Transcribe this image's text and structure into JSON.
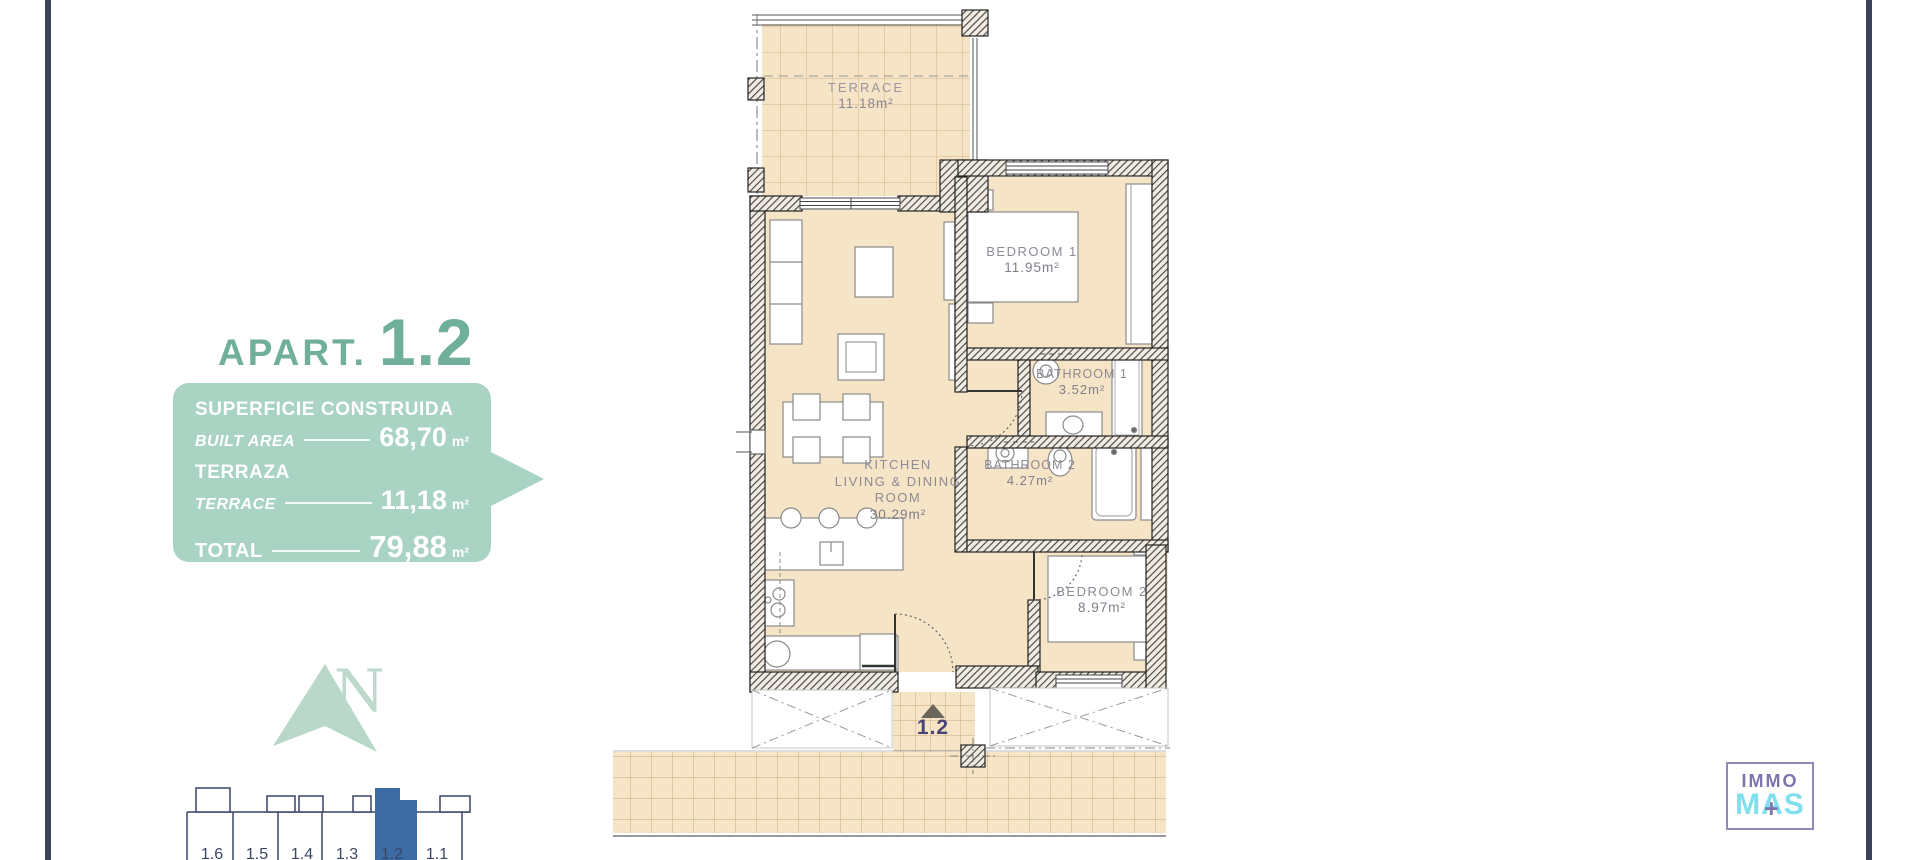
{
  "colors": {
    "accent_teal": "#6FAF9B",
    "box_green": "#A9D3C3",
    "north_green": "#BCD9CB",
    "highlight_blue": "#3D6CA5",
    "border_navy": "#3B4459",
    "floor_tan": "#F6E4C6",
    "entrance_label_navy": "#4A4376",
    "logo_purple": "#7D74AD",
    "logo_cyan": "#7FDFEC"
  },
  "left_panel": {
    "title": {
      "prefix": "APART.",
      "number": "1.2"
    },
    "info_box": {
      "row1_label": "SUPERFICIE CONSTRUIDA",
      "row1_sublabel": "BUILT AREA",
      "row1_value": "68,70",
      "row1_unit": "m²",
      "row2_label": "TERRAZA",
      "row2_sublabel": "TERRACE",
      "row2_value": "11,18",
      "row2_unit": "m²",
      "row3_label": "TOTAL",
      "row3_value": "79,88",
      "row3_unit": "m²"
    },
    "north_letter": "N",
    "building_strip": {
      "units": [
        "1.6",
        "1.5",
        "1.4",
        "1.3",
        "1.2",
        "1.1"
      ],
      "highlighted": "1.2"
    }
  },
  "floor_plan": {
    "terrace": {
      "name": "TERRACE",
      "area": "11.18m²"
    },
    "bedroom1": {
      "name": "BEDROOM 1",
      "area": "11.95m²"
    },
    "bathroom1": {
      "name": "BATHROOM 1",
      "area": "3.52m²"
    },
    "bathroom2": {
      "name": "BATHROOM 2",
      "area": "4.27m²"
    },
    "bedroom2": {
      "name": "BEDROOM 2",
      "area": "8.97m²"
    },
    "living": {
      "line1": "KITCHEN",
      "line2": "LIVING & DINING",
      "line3": "ROOM",
      "area": "30.29m²"
    },
    "entrance": {
      "label": "1.2"
    }
  },
  "logo": {
    "top": "IMMO",
    "bottom": "MAS",
    "plus": "+"
  }
}
